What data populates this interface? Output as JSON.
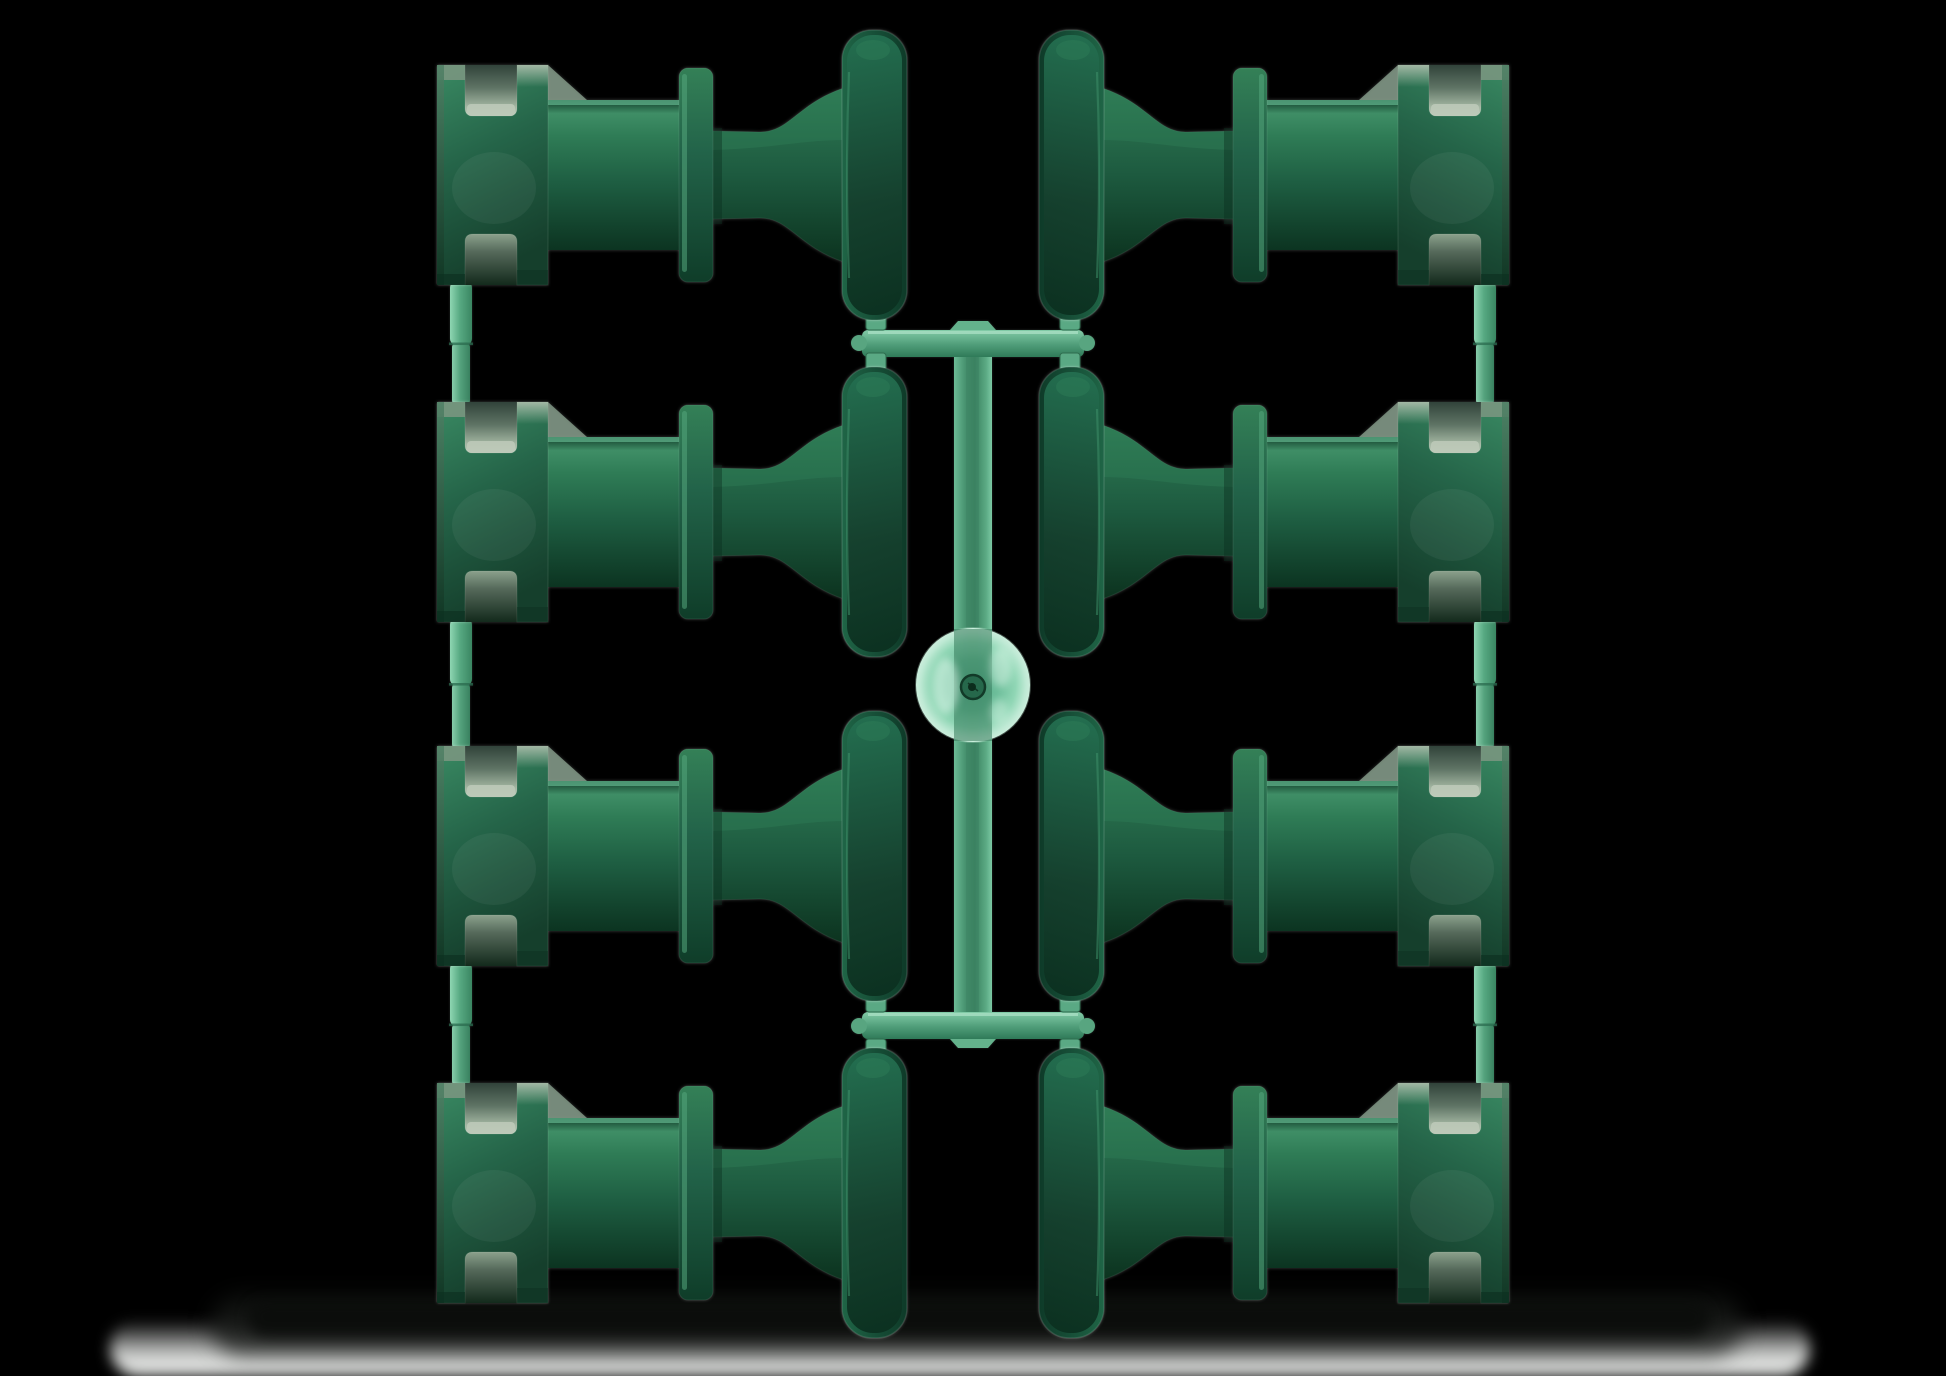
{
  "meta": {
    "type": "product-photo",
    "subject": "Eight dark green injection-molded spool insulator parts attached to a light green plastic sprue runner, on a black background with a soft floor shadow",
    "background": "#000000"
  },
  "scene": {
    "part_count": 8,
    "grid": {
      "columns": 2,
      "rows": 4
    },
    "colors": {
      "part_main": "#1d5c40",
      "part_dark": "#0c3421",
      "part_highlight": "#3f8e66",
      "part_bevel": "#9db3a0",
      "runner": "#57a983",
      "runner_light": "#8ed6b2",
      "puck": "#95ddbb",
      "shadow": "#0b0d0b",
      "floor_glow": "#f6f8f6"
    },
    "puck": {
      "cx": 973,
      "cy": 685,
      "r": 57
    }
  },
  "layout": {
    "stage": {
      "width": 1946,
      "height": 1376
    },
    "part_box": {
      "width": 470,
      "height": 290
    },
    "parts": [
      {
        "name": "part-row1-left",
        "column": "left",
        "x": 437,
        "y": 30
      },
      {
        "name": "part-row2-left",
        "column": "left",
        "x": 437,
        "y": 367
      },
      {
        "name": "part-row3-left",
        "column": "left",
        "x": 437,
        "y": 711
      },
      {
        "name": "part-row4-left",
        "column": "left",
        "x": 437,
        "y": 1048
      },
      {
        "name": "part-row1-right",
        "column": "right",
        "x": 1039,
        "y": 30
      },
      {
        "name": "part-row2-right",
        "column": "right",
        "x": 1039,
        "y": 367
      },
      {
        "name": "part-row3-right",
        "column": "right",
        "x": 1039,
        "y": 711
      },
      {
        "name": "part-row4-right",
        "column": "right",
        "x": 1039,
        "y": 1048
      }
    ],
    "runner": {
      "stem": {
        "x": 954,
        "y": 326,
        "w": 38,
        "h": 717
      },
      "stem_core": {
        "x": 966,
        "y": 330,
        "w": 13,
        "h": 709
      },
      "bars": [
        {
          "x": 862,
          "y": 330,
          "w": 222,
          "h": 27
        },
        {
          "x": 862,
          "y": 1012,
          "w": 222,
          "h": 27
        }
      ],
      "bumps": [
        "950,330 958,321 988,321 996,330",
        "950,1039 958,1048 988,1048 996,1039"
      ],
      "nubs": [
        {
          "cx": 859,
          "cy": 343
        },
        {
          "cx": 1087,
          "cy": 343
        },
        {
          "cx": 859,
          "cy": 1026
        },
        {
          "cx": 1087,
          "cy": 1026
        }
      ],
      "tabs": [
        {
          "x": 866,
          "y": 313
        },
        {
          "x": 1060,
          "y": 313
        },
        {
          "x": 866,
          "y": 353
        },
        {
          "x": 1060,
          "y": 353
        },
        {
          "x": 866,
          "y": 995
        },
        {
          "x": 1060,
          "y": 995
        },
        {
          "x": 866,
          "y": 1039
        },
        {
          "x": 1060,
          "y": 1039
        }
      ],
      "tab_size": {
        "w": 20,
        "h": 17
      },
      "ties": [
        {
          "x": 450,
          "y0": 283,
          "y1": 404
        },
        {
          "x": 450,
          "y0": 620,
          "y1": 748
        },
        {
          "x": 450,
          "y0": 964,
          "y1": 1085
        },
        {
          "x": 1474,
          "y0": 283,
          "y1": 404
        },
        {
          "x": 1474,
          "y0": 620,
          "y1": 748
        },
        {
          "x": 1474,
          "y0": 964,
          "y1": 1085
        }
      ]
    }
  }
}
